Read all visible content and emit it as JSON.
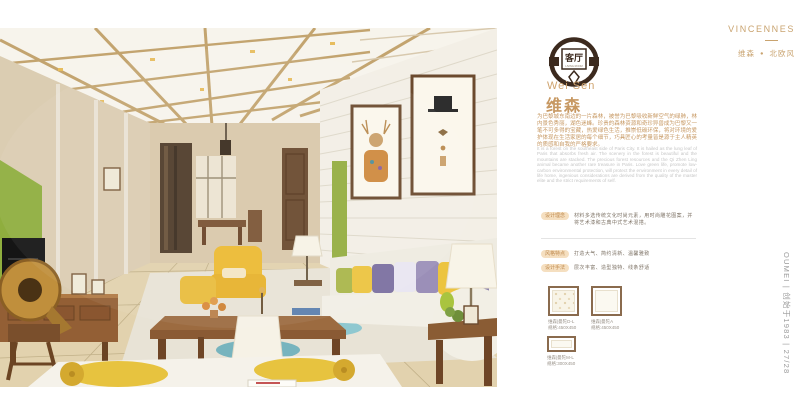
{
  "brand": {
    "name": "VINCENNES"
  },
  "page_tags": {
    "collection": "维森",
    "dot": "●",
    "category": "北欧风"
  },
  "badge": {
    "room": "客厅",
    "sub": "LIVING ROOM"
  },
  "product": {
    "title_en": "Wei Sen",
    "title_cn": "维森"
  },
  "intro": {
    "cn": "为巴黎城东南边的一片森林，被誉为巴黎吸收新鲜空气的绿肺，林内景色秀丽，湖色迷峰。珍贵的森林资源和奇珍异兽成为巴黎又一笔不可多得的宝藏，热爱绿色生活，推崇低碳环保，将对环境的爱护体现在生活家居的每个细节，巧具匠心的考量皆是源于主人精英的质感和自我的严格要求。",
    "en": "It is a forest on the southeast side of Paris City. It is hailed as the lung leaf of Paris that absorbs fresh air. The scenery in the forest is beautiful and the mountains are stacked. The precious forest resources and the Qi Zhen Ling animal became another rare treasure in Paris. Love green life, promote low-carbon environmental protection, will protect the environment in every detail of life home, ingenious considerations are derived from the quality of the master elite and the strict requirements of self."
  },
  "specs": [
    {
      "label": "设计理念",
      "text": "材料多选传统文化时尚元素，用时尚雕花图案，并将艺术漆和古典中式艺术混搭。"
    },
    {
      "label": "风格特点",
      "text": "打造大气、简约清新、温馨雅致"
    },
    {
      "label": "设计手法",
      "text": "层次丰富、造型独特、线条舒适"
    }
  ],
  "swatches": [
    {
      "name": "维森|曼陀D-L",
      "size": "规格:450X450"
    },
    {
      "name": "维森|曼陀A",
      "size": "规格:450X450"
    },
    {
      "name": "维森|曼陀M-L",
      "size": "规格:300X450"
    }
  ],
  "footer": {
    "vertical": "OUMEI | 创始于1983 | 27/28"
  },
  "palette": {
    "accent_tan": "#C79862",
    "pill_bg": "#F5DFC0",
    "english_gray": "#C6C6C6",
    "logo_brown": "#3C2A1E",
    "wall_green": "#8FAE3E",
    "ceiling_gold": "#C3A46F",
    "pillow_yellow": "#ECC43F",
    "pillow_purple": "#7B6FA0"
  }
}
